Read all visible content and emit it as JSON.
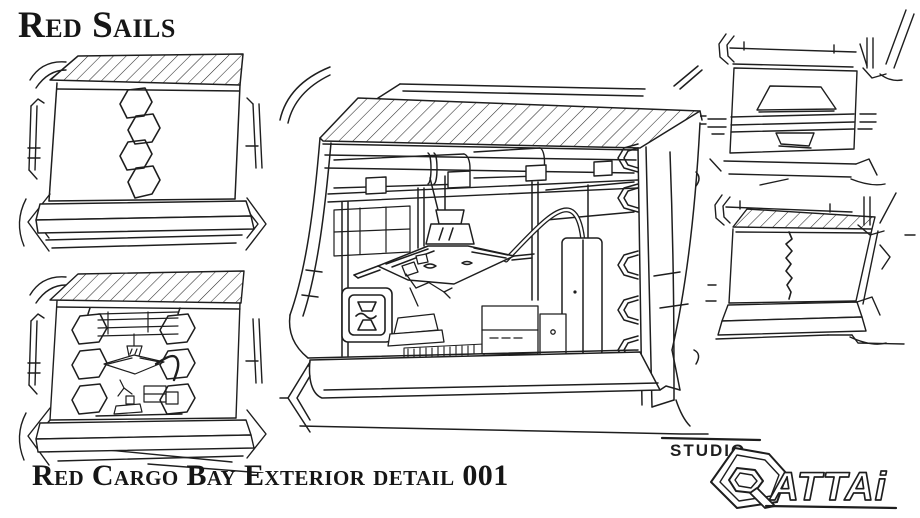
{
  "sheet": {
    "title": "Red Sails",
    "caption": "Red Cargo Bay Exterior detail 001",
    "colors": {
      "paper": "#ffffff",
      "ink": "#1e1e1e"
    },
    "panels": [
      {
        "id": "bay-closed-hex-seam"
      },
      {
        "id": "bay-half-open"
      },
      {
        "id": "bay-open-main-detail"
      },
      {
        "id": "hatch-panel-closed"
      },
      {
        "id": "bay-closed-zigzag-seam"
      }
    ],
    "logo": {
      "studio_label": "STUDIO",
      "wordmark": "ATTAi",
      "emblem": "hexagon-g9-monogram"
    }
  }
}
